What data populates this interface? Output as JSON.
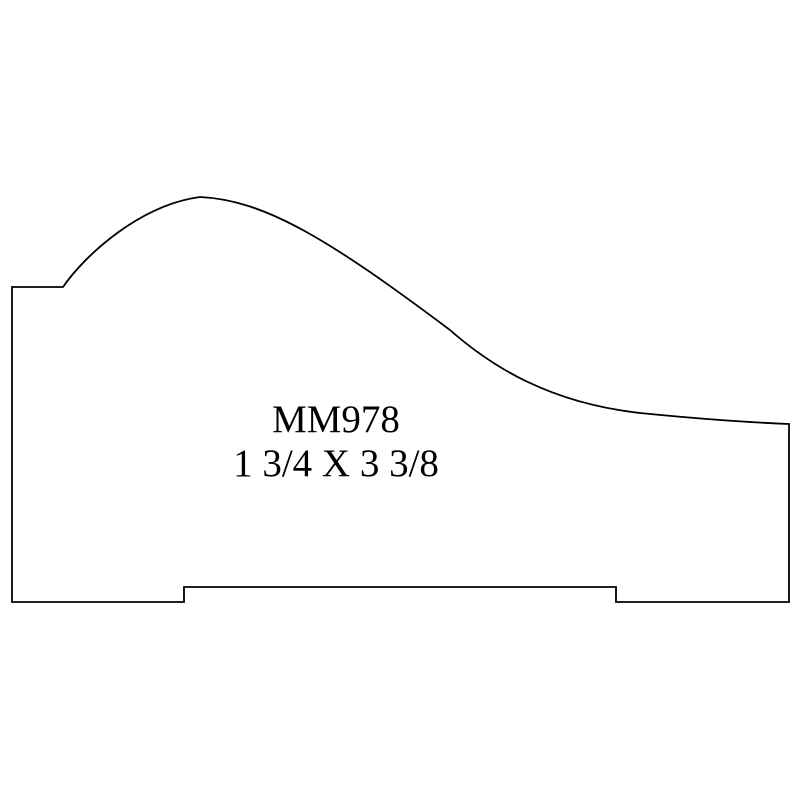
{
  "drawing": {
    "title": "Molding profile drawing",
    "part_number": "MM978",
    "dimensions": "1 3/4 X 3 3/8",
    "line_color": "#000000",
    "background_color": "#ffffff"
  },
  "profile": {
    "description": "Ogee crown molding cross-section outline, flat back with relief groove",
    "path": "M 63 287 C 85 255 140 205 200 197 C 265 200 330 240 450 330 C 492 367 550 403 640 413 C 690 418 740 422 789 424 L 789 602 L 616 602 L 616 587 L 184 587 L 184 602 L 12 602 L 12 287 L 63 287 Z",
    "bounds": {
      "left": 12,
      "top": 197,
      "right": 789,
      "bottom": 602
    }
  }
}
